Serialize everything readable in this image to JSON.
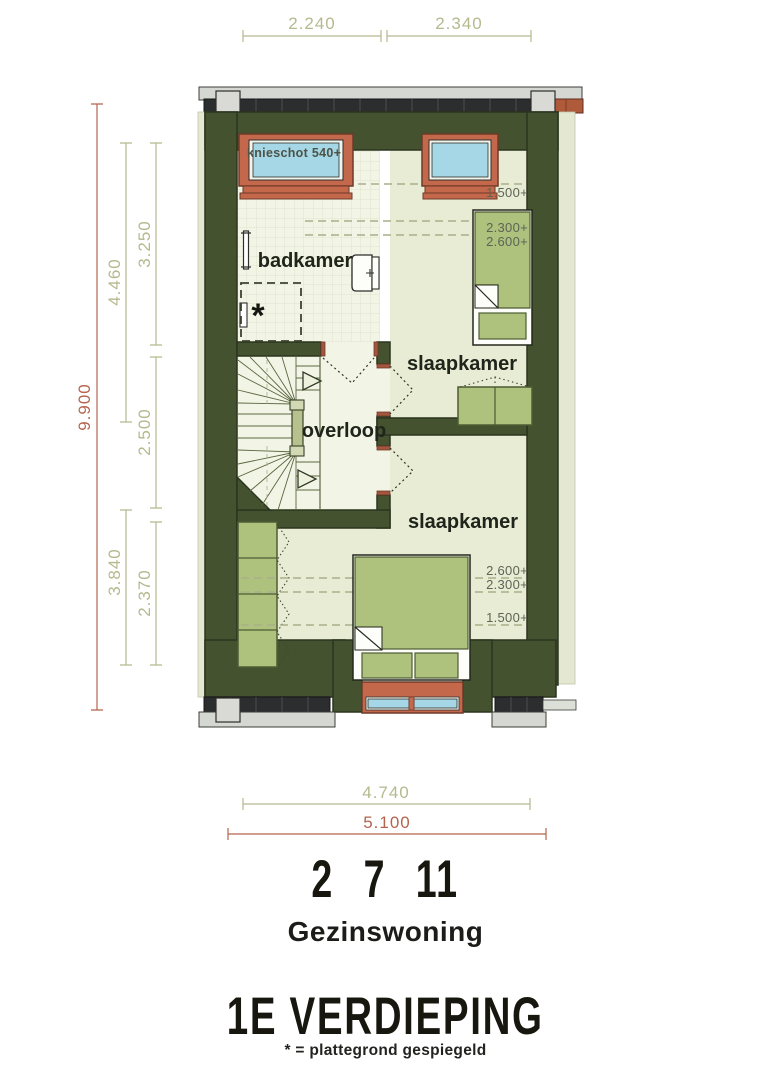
{
  "rooms": {
    "badkamer": "badkamer",
    "overloop": "overloop",
    "slaapkamer_1": "slaapkamer",
    "slaapkamer_2": "slaapkamer"
  },
  "annotations": {
    "knieschot": "knieschot 540+",
    "mirror_marker": "*"
  },
  "height_lines": {
    "top_1500": "1.500+",
    "top_2300": "2.300+",
    "top_2600": "2.600+",
    "bottom_2600": "2.600+",
    "bottom_2300": "2.300+",
    "bottom_1500": "1.500+"
  },
  "dimensions": {
    "top_left": "2.240",
    "top_right": "2.340",
    "left_total": "9.900",
    "left_upper_inner": "4.460",
    "left_upper_room": "3.250",
    "left_middle_room": "2.500",
    "left_lower_inner": "3.840",
    "left_lower_room": "2.370",
    "bottom_inner": "4.740",
    "bottom_total": "5.100"
  },
  "title": {
    "unit_numbers": "2 7 11",
    "house_type": "Gezinswoning",
    "floor_name": "1E VERDIEPING",
    "footnote": "* = plattegrond gespiegeld"
  },
  "colors": {
    "wall_green": "#44522f",
    "floor": "#e9ecd4",
    "hall_floor": "#f2f4e6",
    "furniture_green": "#aec17d",
    "window_frame_red": "#c4684c",
    "glass_blue": "#a5d7e6",
    "roof_tiles_dark": "#2b2d2e",
    "gutter_gray": "#d5d7d3",
    "dimension_olive": "#b5b98e",
    "dimension_red": "#b5644e"
  }
}
